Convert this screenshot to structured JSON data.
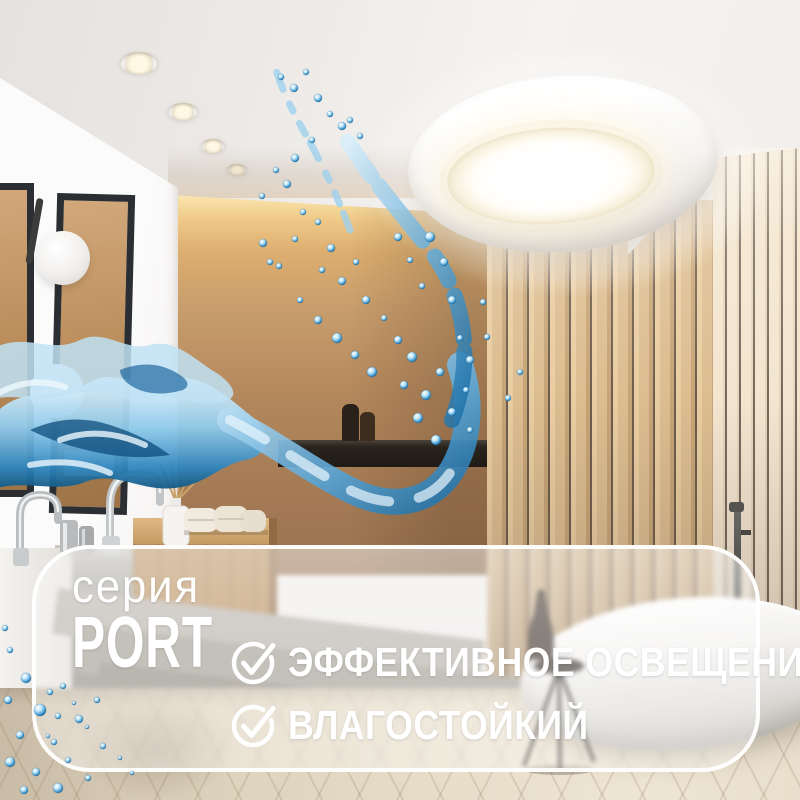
{
  "banner": {
    "series_label": "серия",
    "series_name": "PORT",
    "features": [
      {
        "icon": "check-circle-icon",
        "label": "ЭФФЕКТИВНОЕ ОСВЕЩЕНИЕ"
      },
      {
        "icon": "check-circle-icon",
        "label": "ВЛАГОСТОЙКИЙ"
      }
    ],
    "colors": {
      "panel_border": "#ffffff",
      "text": "#ffffff"
    }
  },
  "scene": {
    "water_accent_color": "#2f85bd",
    "cove_glow_color": "#f8dfa6"
  }
}
